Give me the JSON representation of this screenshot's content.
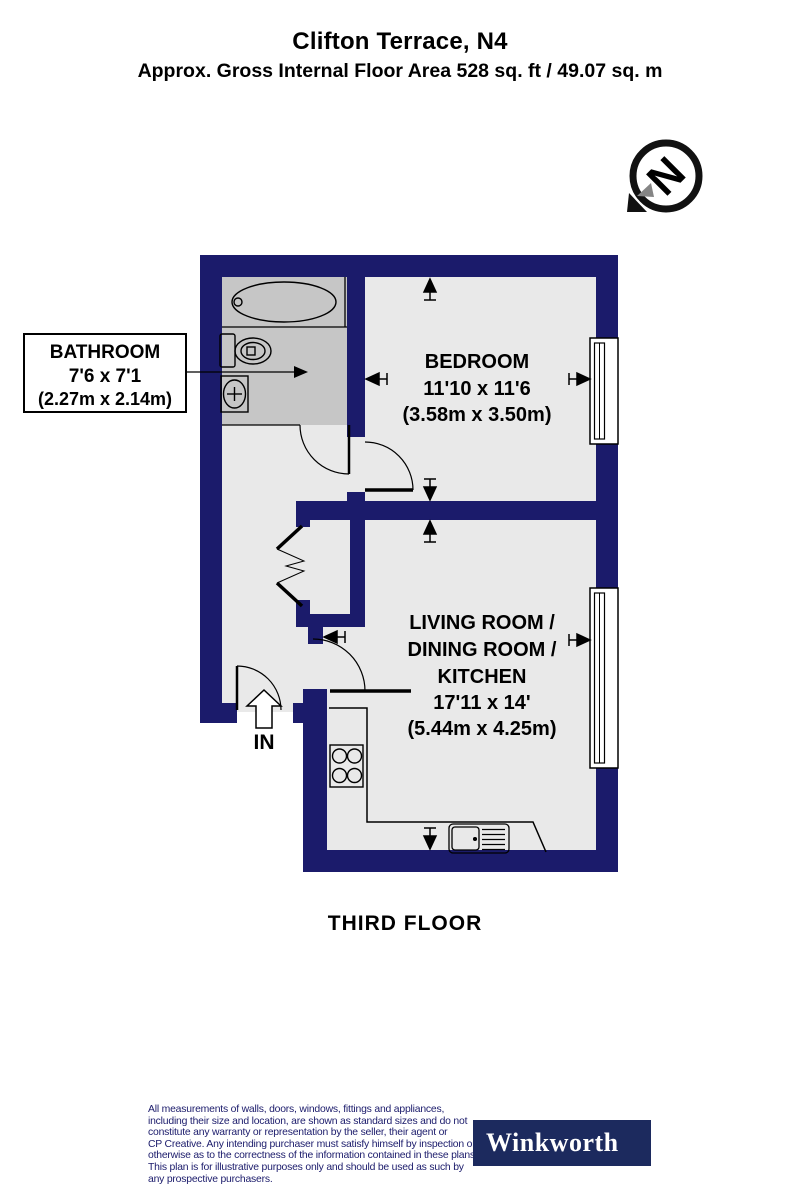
{
  "header": {
    "title": "Clifton Terrace, N4",
    "subtitle": "Approx. Gross Internal Floor Area 528 sq. ft / 49.07 sq. m"
  },
  "compass": {
    "letter": "N"
  },
  "floorplan": {
    "floor_label": "THIRD FLOOR",
    "entrance_label": "IN",
    "rooms": {
      "bathroom": {
        "name": "BATHROOM",
        "dims_ft": "7'6 x 7'1",
        "dims_m": "(2.27m x 2.14m)"
      },
      "bedroom": {
        "name": "BEDROOM",
        "dims_ft": "11'10 x 11'6",
        "dims_m": "(3.58m x 3.50m)"
      },
      "living": {
        "name_line1": "LIVING ROOM /",
        "name_line2": "DINING ROOM /",
        "name_line3": "KITCHEN",
        "dims_ft": "17'11 x 14'",
        "dims_m": "(5.44m x 4.25m)"
      }
    },
    "colors": {
      "wall": "#1b1b6b",
      "room_fill": "#e9e9e9",
      "bathroom_fill": "#c6c6c6"
    }
  },
  "footer": {
    "disclaimer_lines": [
      "All measurements of walls, doors, windows, fittings and appliances,",
      "including their size and location, are shown as standard sizes and do not",
      "constitute any warranty or representation by the seller, their agent or",
      "CP Creative. Any intending purchaser must satisfy himself by inspection or",
      "otherwise as to the correctness of the information contained in these plans.",
      "This plan is for illustrative purposes only and should be used as such by",
      "any prospective purchasers."
    ],
    "brand": "Winkworth"
  }
}
